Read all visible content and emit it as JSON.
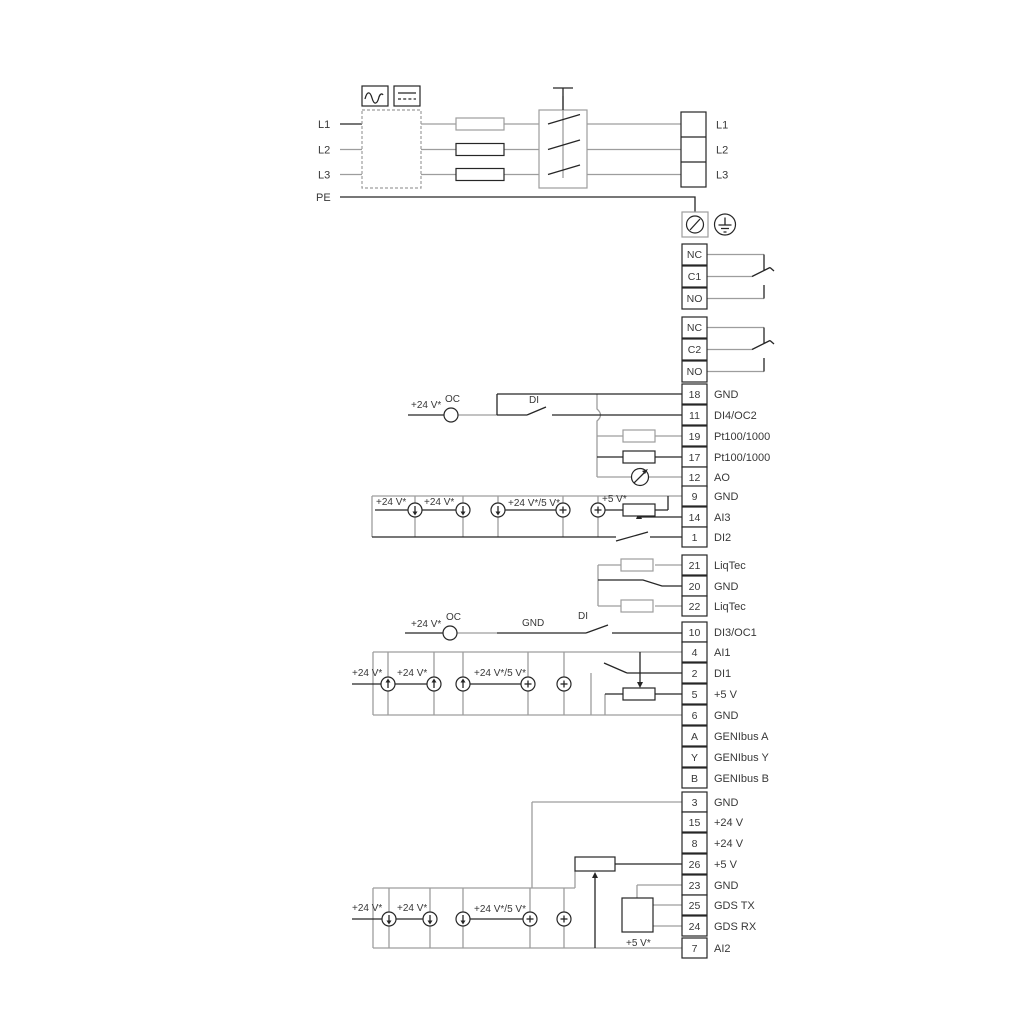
{
  "diagram": {
    "power_in": {
      "l1": "L1",
      "l2": "L2",
      "l3": "L3",
      "pe": "PE"
    },
    "power_out": {
      "l1": "L1",
      "l2": "L2",
      "l3": "L3"
    },
    "relay1": {
      "nc": "NC",
      "c": "C1",
      "no": "NO"
    },
    "relay2": {
      "nc": "NC",
      "c": "C2",
      "no": "NO"
    },
    "terminals": [
      {
        "num": "18",
        "label": "GND"
      },
      {
        "num": "11",
        "label": "DI4/OC2"
      },
      {
        "num": "19",
        "label": "Pt100/1000"
      },
      {
        "num": "17",
        "label": "Pt100/1000"
      },
      {
        "num": "12",
        "label": "AO"
      },
      {
        "num": "9",
        "label": "GND"
      },
      {
        "num": "14",
        "label": "AI3"
      },
      {
        "num": "1",
        "label": "DI2"
      },
      {
        "num": "21",
        "label": "LiqTec"
      },
      {
        "num": "20",
        "label": "GND"
      },
      {
        "num": "22",
        "label": "LiqTec"
      },
      {
        "num": "10",
        "label": "DI3/OC1"
      },
      {
        "num": "4",
        "label": "AI1"
      },
      {
        "num": "2",
        "label": "DI1"
      },
      {
        "num": "5",
        "label": "+5 V"
      },
      {
        "num": "6",
        "label": "GND"
      },
      {
        "num": "A",
        "label": "GENIbus A"
      },
      {
        "num": "Y",
        "label": "GENIbus Y"
      },
      {
        "num": "B",
        "label": "GENIbus B"
      },
      {
        "num": "3",
        "label": "GND"
      },
      {
        "num": "15",
        "label": "+24 V"
      },
      {
        "num": "8",
        "label": "+24 V"
      },
      {
        "num": "26",
        "label": "+5 V"
      },
      {
        "num": "23",
        "label": "GND"
      },
      {
        "num": "25",
        "label": "GDS TX"
      },
      {
        "num": "24",
        "label": "GDS RX"
      },
      {
        "num": "7",
        "label": "AI2"
      }
    ],
    "di4": {
      "v24": "+24 V*",
      "oc": "OC",
      "di": "DI"
    },
    "ai3": {
      "v24_1": "+24 V*",
      "v24_2": "+24 V*",
      "v24_5": "+24 V*/5 V*",
      "v5": "+5 V*"
    },
    "di3": {
      "v24": "+24 V*",
      "oc": "OC",
      "gnd": "GND",
      "di": "DI"
    },
    "ai1": {
      "v24_1": "+24 V*",
      "v24_2": "+24 V*",
      "v24_5": "+24 V*/5 V*"
    },
    "ai2": {
      "v24_1": "+24 V*",
      "v24_2": "+24 V*",
      "v24_5": "+24 V*/5 V*",
      "v5": "+5 V*"
    },
    "colors": {
      "line": "#262626",
      "gray": "#9d9d9d",
      "text": "#383838"
    }
  }
}
